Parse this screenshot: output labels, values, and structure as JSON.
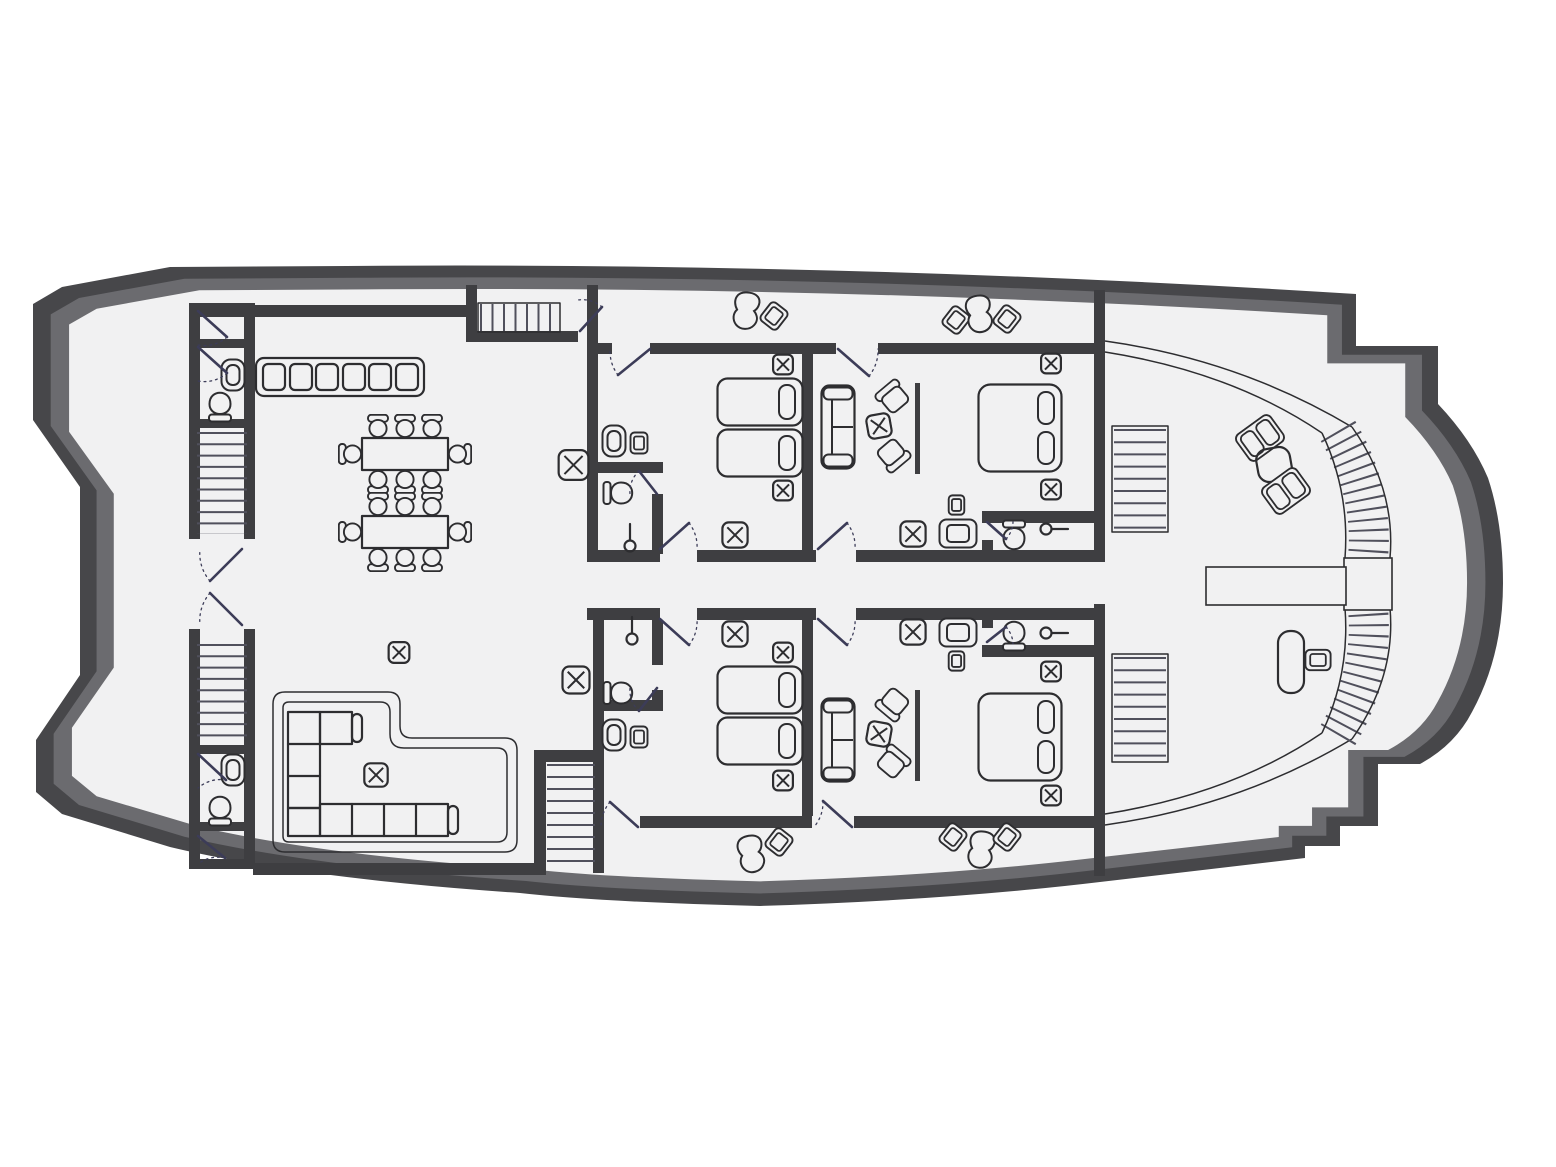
{
  "plan": {
    "vessel": "motor-yacht main deck floor plan",
    "orientation": "bow-left-stern-right",
    "summary": {
      "guest_cabins": 4,
      "twin_cabins": 2,
      "double_cabins": 2,
      "bathrooms": 6,
      "toilets": 6,
      "sinks": 6,
      "showers": 4,
      "staircases_straight": 6,
      "staircases_curved": 2,
      "dining_tables": 2,
      "dining_chairs": 16,
      "chaise_lounges": 4,
      "wardrobes": 2
    },
    "rooms": [
      {
        "name": "bow-deck",
        "furniture": []
      },
      {
        "name": "forward-room-port",
        "furniture": [
          "door"
        ]
      },
      {
        "name": "forward-wc-port",
        "furniture": [
          "sink",
          "toilet",
          "door"
        ]
      },
      {
        "name": "forward-stairs-port",
        "furniture": [
          "staircase"
        ]
      },
      {
        "name": "entrance-vestibule",
        "furniture": [
          "double-swing-doors"
        ]
      },
      {
        "name": "forward-stairs-starboard",
        "furniture": [
          "staircase"
        ]
      },
      {
        "name": "forward-wc-starboard",
        "furniture": [
          "sink",
          "toilet",
          "door"
        ]
      },
      {
        "name": "forward-room-starboard",
        "furniture": [
          "door"
        ]
      },
      {
        "name": "salon-dining",
        "furniture": [
          "galley-counter-6-units",
          "dining-table",
          "dining-table",
          "dining-chair-x16",
          "side-table-x"
        ]
      },
      {
        "name": "salon-lounge",
        "furniture": [
          "l-shaped-sofa-on-platform",
          "coffee-table-x",
          "side-table-x"
        ]
      },
      {
        "name": "mid-stairs-up",
        "furniture": [
          "staircase",
          "door"
        ]
      },
      {
        "name": "mid-stairs-down",
        "furniture": [
          "staircase"
        ]
      },
      {
        "name": "corridor",
        "furniture": [
          "wardrobe-x",
          "wardrobe-x"
        ]
      },
      {
        "name": "twin-cabin-port",
        "furniture": [
          "single-bed",
          "single-bed",
          "nightstand-x",
          "nightstand-x",
          "ottoman-x",
          "sink",
          "stool",
          "bathroom-toilet",
          "shower-head",
          "doors"
        ]
      },
      {
        "name": "double-cabin-port",
        "furniture": [
          "sofa",
          "armchair",
          "armchair",
          "coffee-table-x",
          "tv-line",
          "double-bed",
          "nightstand-x",
          "nightstand-x",
          "ottoman-x",
          "tv-cabinet",
          "stool",
          "bathroom-toilet",
          "shower-head",
          "doors"
        ]
      },
      {
        "name": "twin-cabin-starboard",
        "furniture": [
          "single-bed",
          "single-bed",
          "nightstand-x",
          "nightstand-x",
          "ottoman-x",
          "sink",
          "stool",
          "bathroom-toilet",
          "shower-head",
          "doors"
        ]
      },
      {
        "name": "double-cabin-starboard",
        "furniture": [
          "sofa",
          "armchair",
          "armchair",
          "coffee-table-x",
          "tv-line",
          "double-bed",
          "nightstand-x",
          "nightstand-x",
          "ottoman-x",
          "tv-cabinet",
          "stool",
          "bathroom-toilet",
          "shower-head",
          "doors"
        ]
      },
      {
        "name": "side-walkway-port",
        "furniture": [
          "chaise-lounge",
          "side-table",
          "side-table",
          "chaise-lounge",
          "side-table"
        ]
      },
      {
        "name": "side-walkway-starboard",
        "furniture": [
          "chaise-lounge",
          "side-table",
          "side-table",
          "chaise-lounge",
          "side-table"
        ]
      },
      {
        "name": "aft-deck",
        "furniture": [
          "side-stairs",
          "side-stairs",
          "deck-chair",
          "deck-chair",
          "deck-table",
          "desk",
          "desk-chair",
          "gangway-bench",
          "stern-landing",
          "curved-staircase",
          "curved-staircase",
          "railing-curves"
        ]
      }
    ],
    "symbols_legend": [
      "single-bed",
      "double-bed",
      "nightstand-x",
      "ottoman-x",
      "wardrobe-x",
      "sofa",
      "armchair",
      "deck-chair",
      "chaise-lounge",
      "coffee-table-x",
      "dining-table",
      "dining-chair",
      "side-table",
      "galley-counter",
      "toilet",
      "sink",
      "shower-head",
      "stool",
      "tv-cabinet",
      "tv-line",
      "desk",
      "staircase",
      "curved-staircase",
      "door-leaf",
      "door-swing-arc",
      "l-shaped-sofa"
    ]
  },
  "colors": {
    "page_bg": "#ffffff",
    "hull_dark": "#47474a",
    "hull_mid": "#6b6b6f",
    "floor": "#f1f1f2",
    "wall": "#3e3e41",
    "furniture_line": "#2d2d30",
    "door_line": "#3c3c58",
    "stair_tread": "#50505c"
  }
}
